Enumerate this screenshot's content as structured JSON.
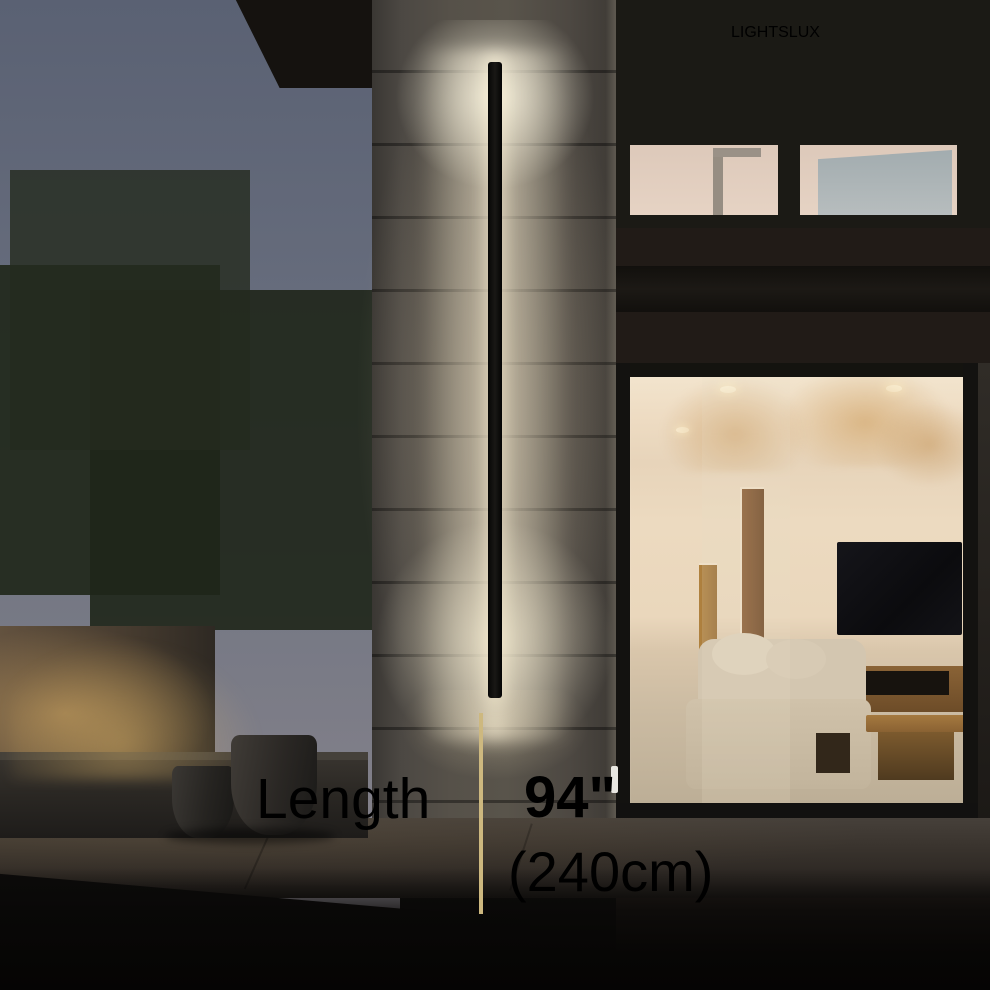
{
  "brand": {
    "name": "LIGHTSLUX",
    "color": "#b3a173"
  },
  "spec": {
    "label": "Length",
    "imperial": "94\"",
    "metric": "(240cm)",
    "divider_color": "#cdb87f",
    "text_color": "#ffffff"
  }
}
